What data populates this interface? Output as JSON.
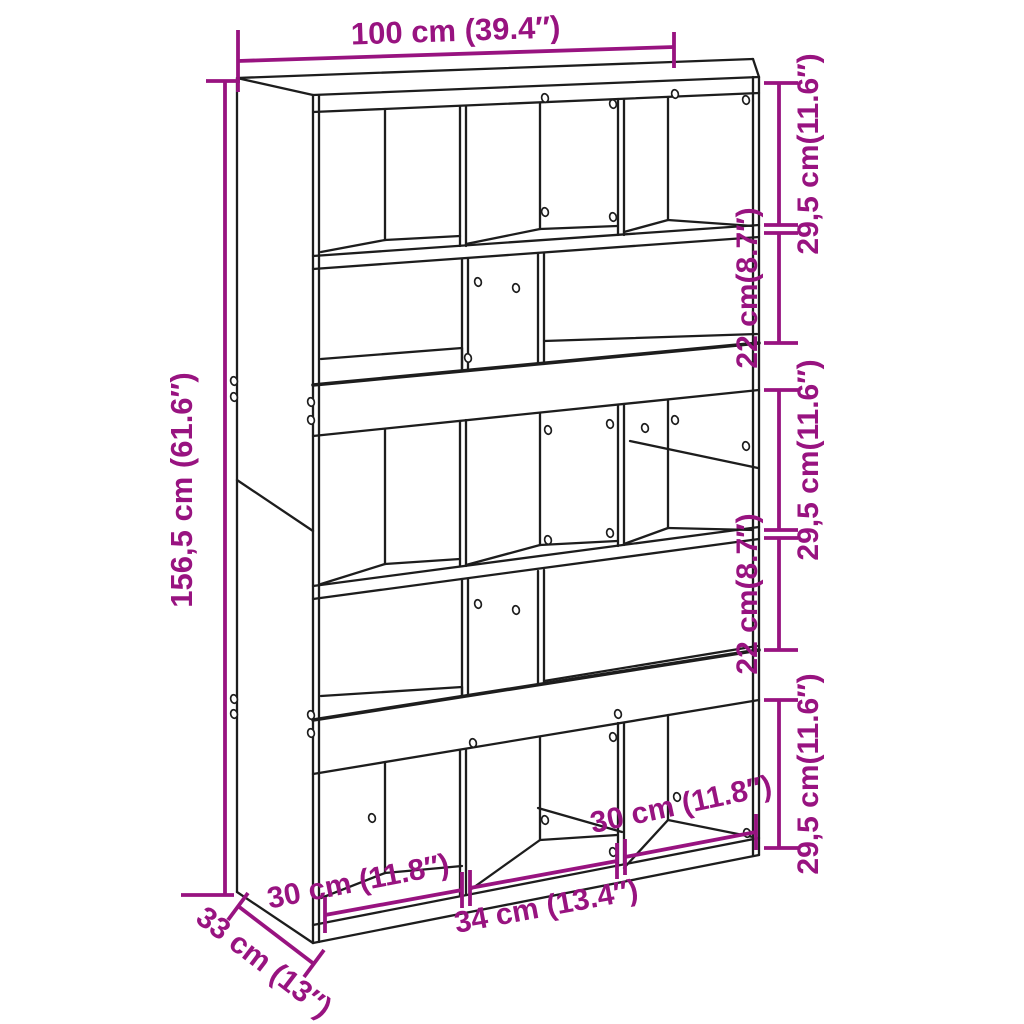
{
  "figure": {
    "subject": "bookcase-room-divider-line-drawing",
    "background": "#ffffff",
    "line_color": "#1d1d1d",
    "dimension_color": "#981380",
    "dimensions": {
      "width": {
        "label": "100 cm (39.4″)"
      },
      "height": {
        "label": "156,5 cm (61.6″)"
      },
      "depth": {
        "label": "33 cm (13″)"
      },
      "right_segments": [
        {
          "label": "29,5 cm(11.6″)"
        },
        {
          "label": "22 cm(8.7″)"
        },
        {
          "label": "29,5 cm(11.6″)"
        },
        {
          "label": "22 cm(8.7″)"
        },
        {
          "label": "29,5 cm(11.6″)"
        }
      ],
      "bottom_segments": [
        {
          "label": "30 cm (11.8″)"
        },
        {
          "label": "34 cm (13.4″)"
        },
        {
          "label": "30 cm (11.8″)"
        }
      ]
    }
  }
}
